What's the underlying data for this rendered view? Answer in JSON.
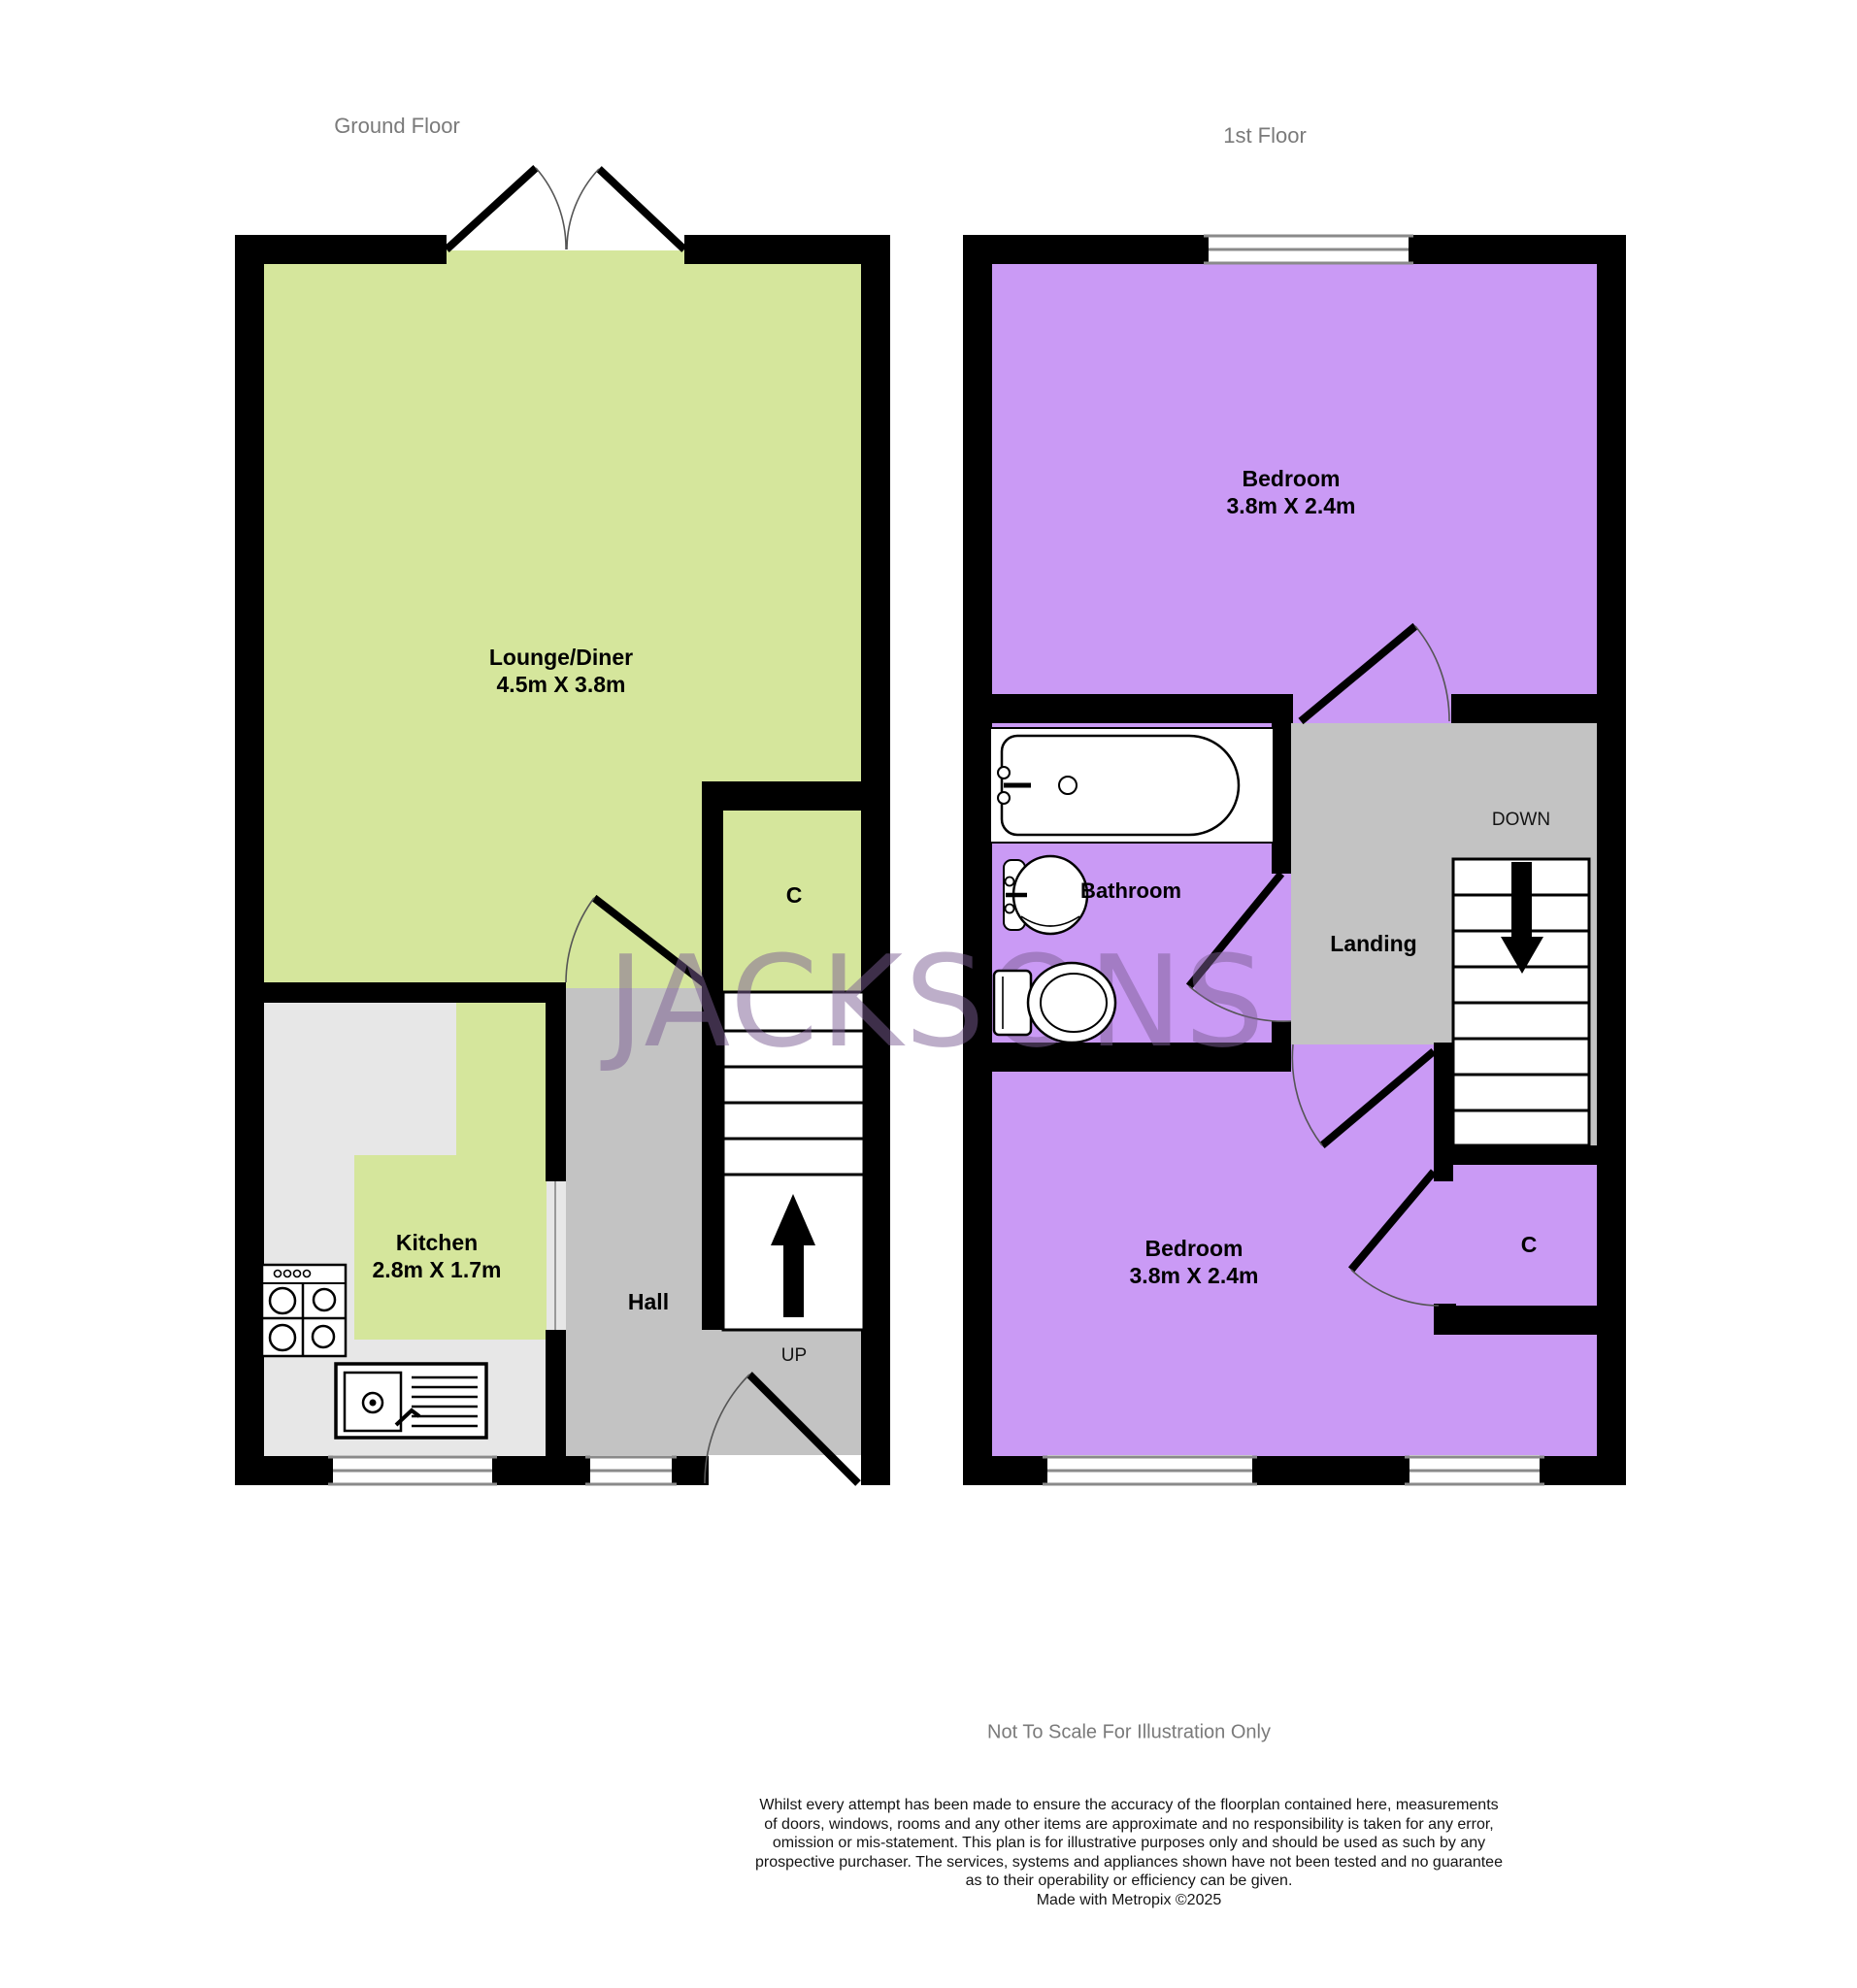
{
  "ground_floor": {
    "title": "Ground Floor",
    "rooms": {
      "lounge": {
        "name": "Lounge/Diner",
        "dims": "4.5m X 3.8m"
      },
      "kitchen": {
        "name": "Kitchen",
        "dims": "2.8m X 1.7m"
      },
      "hall": {
        "name": "Hall"
      },
      "cupboard": {
        "label": "C"
      },
      "stairs": {
        "direction": "UP"
      }
    }
  },
  "first_floor": {
    "title": "1st Floor",
    "rooms": {
      "bedroom_front": {
        "name": "Bedroom",
        "dims": "3.8m X 2.4m"
      },
      "bathroom": {
        "name": "Bathroom"
      },
      "landing": {
        "name": "Landing"
      },
      "bedroom_back": {
        "name": "Bedroom",
        "dims": "3.8m X 2.4m"
      },
      "cupboard": {
        "label": "C"
      },
      "stairs": {
        "direction": "DOWN"
      }
    }
  },
  "watermark": {
    "text": "JACKSONS"
  },
  "footer": {
    "scale_note": "Not To Scale For Illustration Only",
    "disclaimer": [
      "Whilst every attempt has been made to ensure the accuracy of the floorplan contained here, measurements",
      "of doors, windows, rooms and any other items are approximate and no responsibility is taken for any error,",
      "omission or mis-statement. This plan is for illustrative purposes only and should be used as such by any",
      "prospective purchaser. The services, systems and appliances shown have not been tested and no guarantee",
      "as to their operability or efficiency can be given.",
      "Made with Metropix ©2025"
    ]
  },
  "colors": {
    "green": "#d5e69c",
    "purple": "#ca9af5",
    "hall_gray": "#c3c3c3",
    "counter_gray": "#e7e7e7",
    "wall": "#000000",
    "window_line": "#8a8a8a",
    "door_arc": "#555555",
    "title_gray": "#7a7a7a",
    "watermark": "rgba(124,94,148,0.5)"
  }
}
